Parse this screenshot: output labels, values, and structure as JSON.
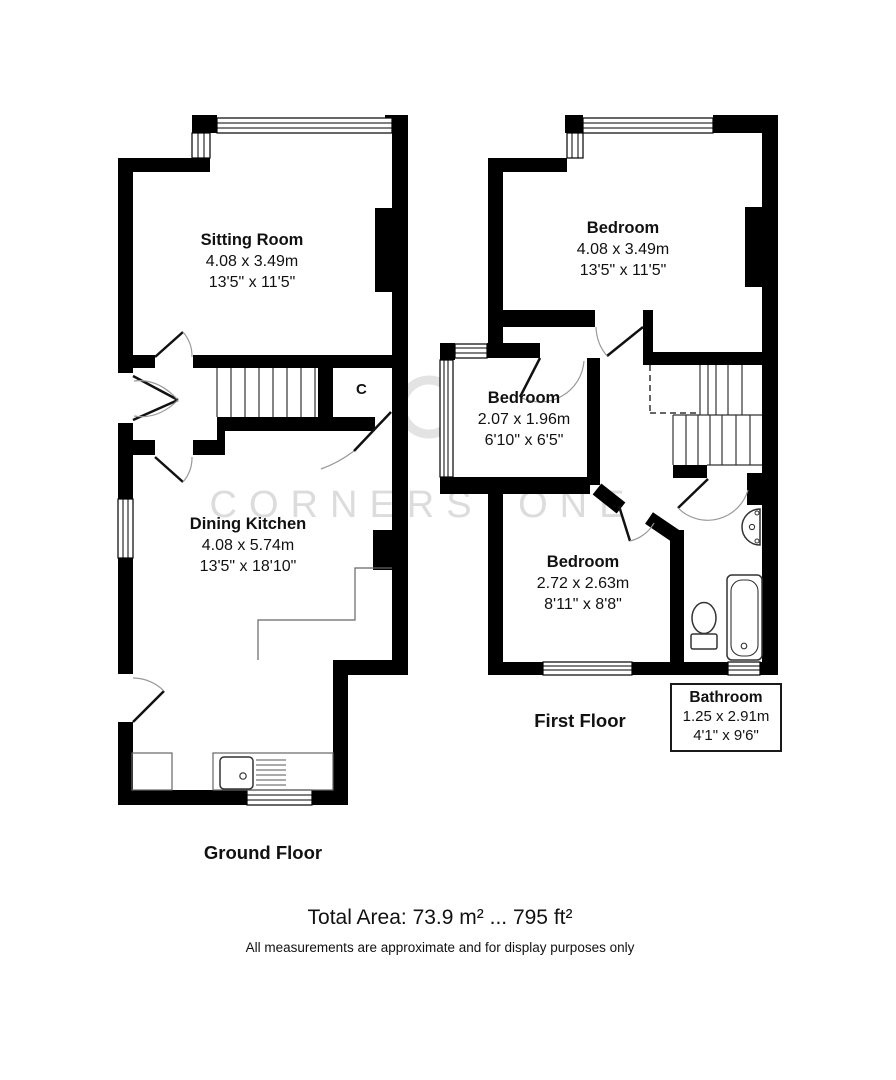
{
  "watermark": {
    "text": "CORNERSTONE"
  },
  "ground_floor": {
    "label": "Ground Floor",
    "cupboard_label": "C",
    "rooms": [
      {
        "name": "Sitting Room",
        "metric": "4.08 x 3.49m",
        "imperial": "13'5\" x 11'5\""
      },
      {
        "name": "Dining Kitchen",
        "metric": "4.08 x 5.74m",
        "imperial": "13'5\" x 18'10\""
      }
    ]
  },
  "first_floor": {
    "label": "First Floor",
    "rooms": [
      {
        "name": "Bedroom",
        "metric": "4.08 x 3.49m",
        "imperial": "13'5\" x 11'5\""
      },
      {
        "name": "Bedroom",
        "metric": "2.07 x 1.96m",
        "imperial": "6'10\" x 6'5\""
      },
      {
        "name": "Bedroom",
        "metric": "2.72 x 2.63m",
        "imperial": "8'11\" x 8'8\""
      },
      {
        "name": "Bathroom",
        "metric": "1.25 x 2.91m",
        "imperial": "4'1\" x 9'6\""
      }
    ]
  },
  "footer": {
    "total_area": "Total Area: 73.9 m² ... 795 ft²",
    "disclaimer": "All measurements are approximate and for display purposes only"
  },
  "colors": {
    "wall": "#000000",
    "watermark": "#dcdcdc"
  }
}
